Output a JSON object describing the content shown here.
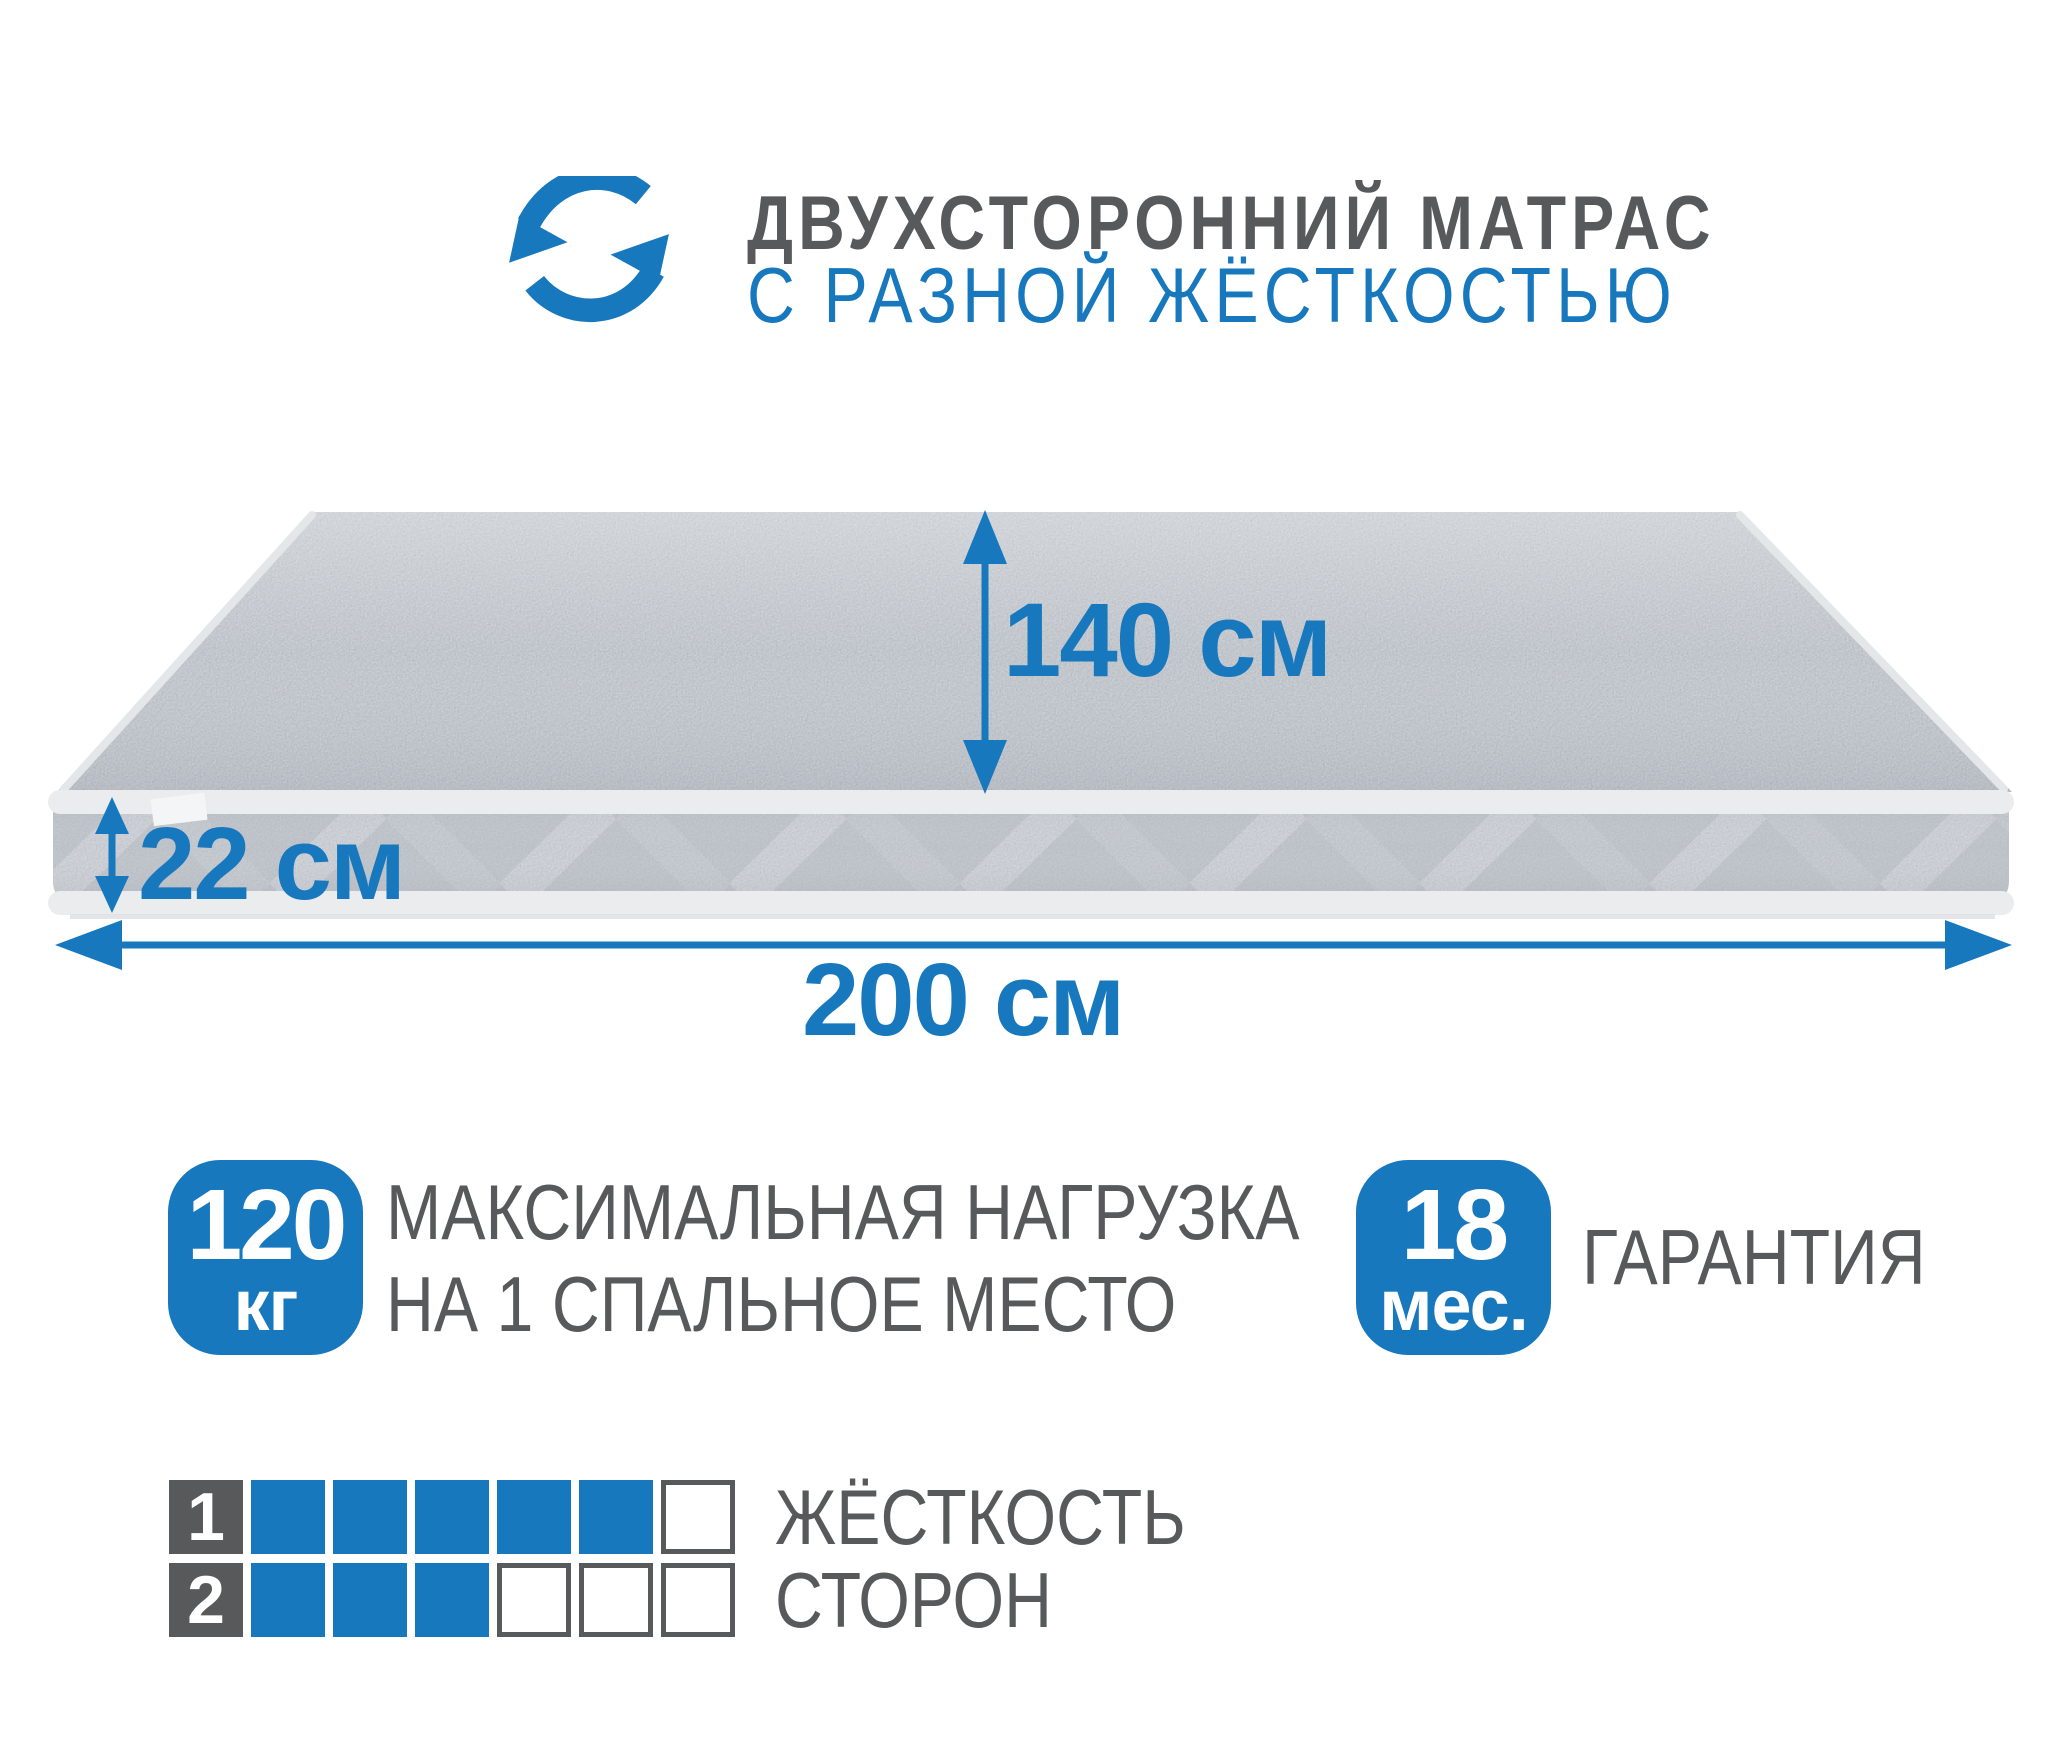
{
  "colors": {
    "accent_blue": "#1778be",
    "text_gray": "#58595b",
    "mattress_top": "#cbd0d5",
    "mattress_side": "#c3c8ce",
    "piping": "#eaecee"
  },
  "header": {
    "title": "ДВУХСТОРОННИЙ МАТРАС",
    "subtitle": "С РАЗНОЙ ЖЁСТКОСТЬЮ",
    "icon": "rotate-arrows-icon"
  },
  "dimensions": {
    "width": {
      "value": "140",
      "unit": "см"
    },
    "height": {
      "value": "22",
      "unit": "см"
    },
    "length": {
      "value": "200",
      "unit": "см"
    }
  },
  "max_load": {
    "value": "120",
    "unit": "кг",
    "label_line1": "МАКСИМАЛЬНАЯ НАГРУЗКА",
    "label_line2": "НА 1 СПАЛЬНОЕ МЕСТО"
  },
  "warranty": {
    "value": "18",
    "unit": "мес.",
    "label": "ГАРАНТИЯ"
  },
  "firmness": {
    "label_line1": "ЖЁСТКОСТЬ",
    "label_line2": "СТОРОН",
    "scale_max": 6,
    "rows": [
      {
        "side": "1",
        "filled": 5
      },
      {
        "side": "2",
        "filled": 3
      }
    ]
  }
}
